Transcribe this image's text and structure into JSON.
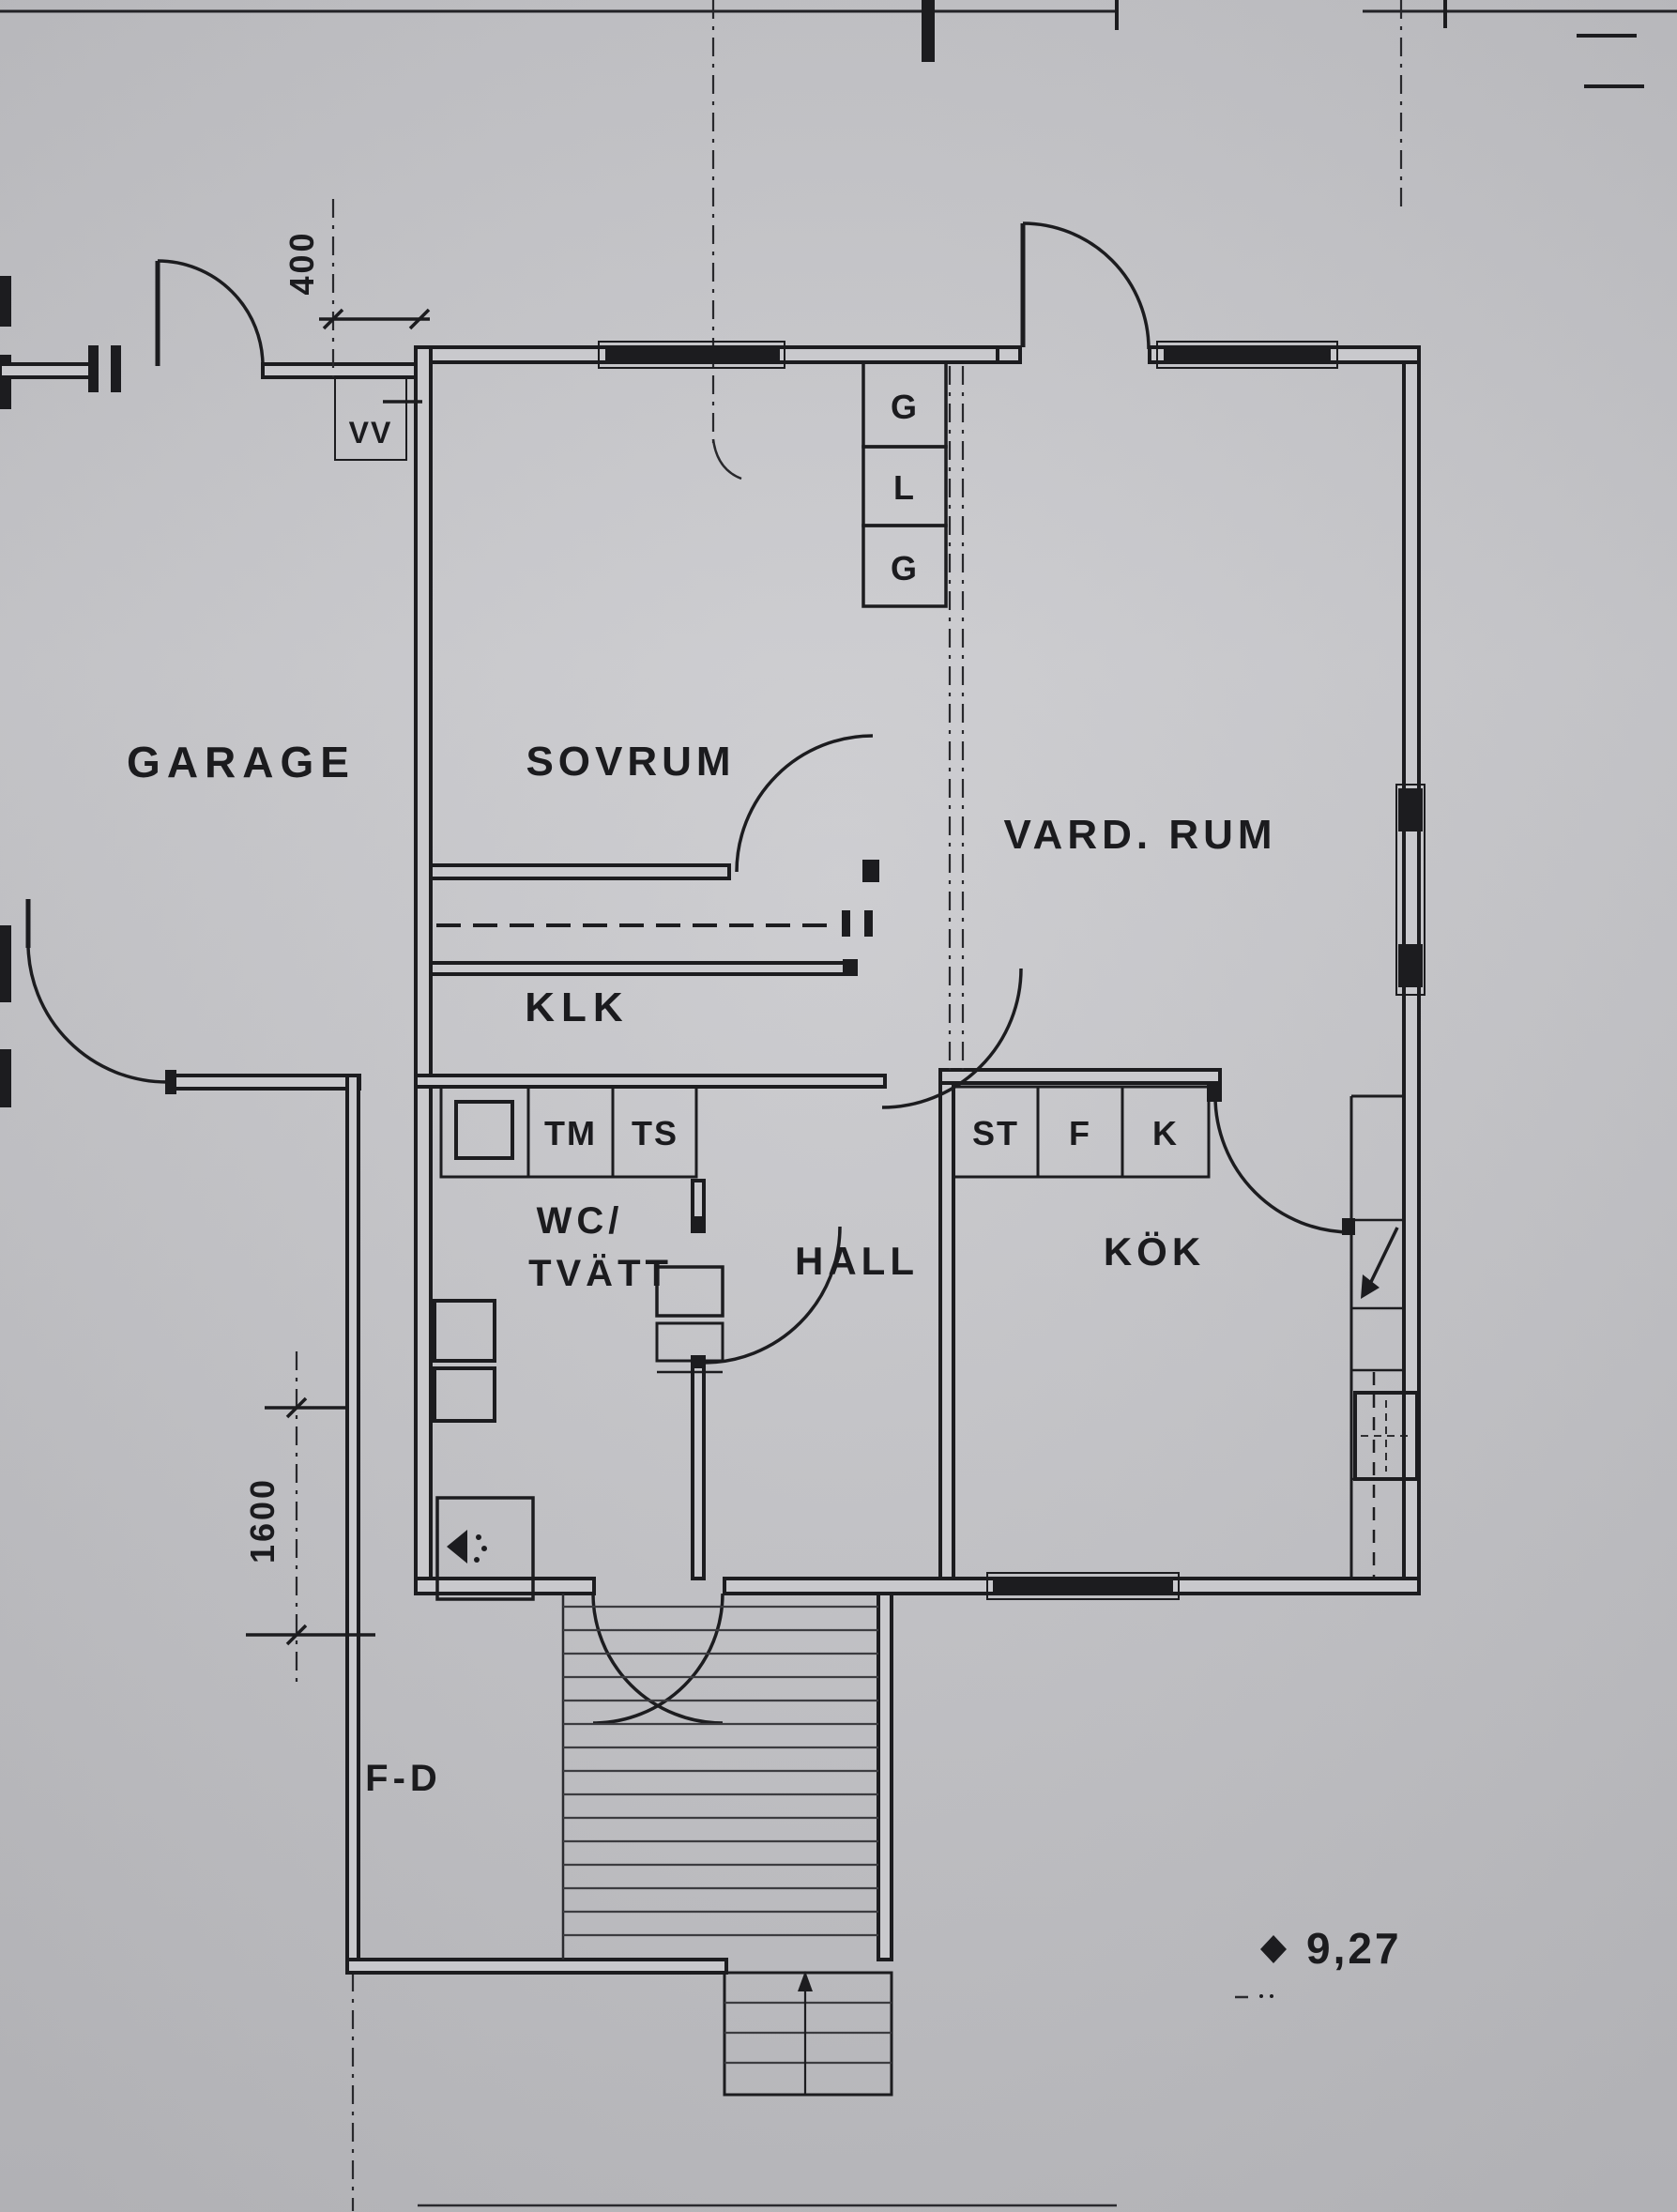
{
  "colors": {
    "paper": "#c9c9cd",
    "ink": "#1c1c1f"
  },
  "rooms": {
    "garage": "GARAGE",
    "bedroom": "SOVRUM",
    "living_room": "VARD. RUM",
    "closet": "KLK",
    "wc_laundry_line1": "WC/",
    "wc_laundry_line2": "TVÄTT",
    "hall": "HALL",
    "kitchen": "KÖK",
    "entry": "F-D"
  },
  "fixtures": {
    "wardrobe_top": "G",
    "linen_cabinet": "L",
    "wardrobe_bottom": "G",
    "washing_machine": "TM",
    "drying_cabinet": "TS",
    "cleaning_cabinet": "ST",
    "freezer": "F",
    "fridge": "K",
    "water_heater": "VV"
  },
  "dimensions": {
    "garage_top": "400",
    "garage_side": "1600"
  },
  "elevation_marker": {
    "value": "9,27"
  }
}
